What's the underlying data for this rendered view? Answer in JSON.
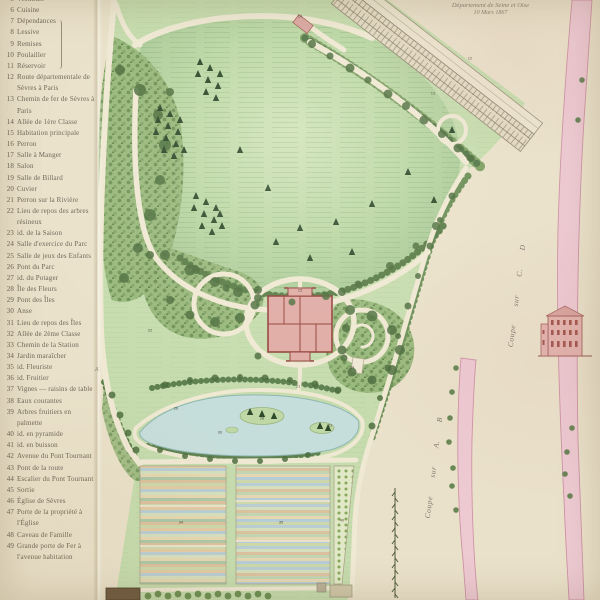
{
  "title": {
    "line1": "Département de Seine et Oise",
    "line2": "10 Mars 1867"
  },
  "legend": {
    "items": [
      {
        "num": "5",
        "label": "Vestibule"
      },
      {
        "num": "6",
        "label": "Cuisine"
      },
      {
        "num": "7",
        "label": "Dépendances"
      },
      {
        "num": "8",
        "label": "Lessive"
      },
      {
        "num": "9",
        "label": "Remises"
      },
      {
        "num": "10",
        "label": "Poulailler"
      },
      {
        "num": "11",
        "label": "Réservoir"
      },
      {
        "num": "12",
        "label": "Route départementale de Sèvres à Paris"
      },
      {
        "num": "13",
        "label": "Chemin de fer de Sèvres à Paris"
      },
      {
        "num": "14",
        "label": "Allée de 1ère Classe"
      },
      {
        "num": "15",
        "label": "Habitation principale"
      },
      {
        "num": "16",
        "label": "Perron"
      },
      {
        "num": "17",
        "label": "Salle à Manger"
      },
      {
        "num": "18",
        "label": "Salon"
      },
      {
        "num": "19",
        "label": "Salle de Billard"
      },
      {
        "num": "20",
        "label": "Cuvier"
      },
      {
        "num": "21",
        "label": "Perron sur la Rivière"
      },
      {
        "num": "22",
        "label": "Lieu de repos des arbres résineux"
      },
      {
        "num": "23",
        "label": "id. de la Saison"
      },
      {
        "num": "24",
        "label": "Salle d'exercice du Parc"
      },
      {
        "num": "25",
        "label": "Salle de jeux des Enfants"
      },
      {
        "num": "26",
        "label": "Pont du Parc"
      },
      {
        "num": "27",
        "label": "id. du Potager"
      },
      {
        "num": "28",
        "label": "Île des Fleurs"
      },
      {
        "num": "29",
        "label": "Pont des Îles"
      },
      {
        "num": "30",
        "label": "Anse"
      },
      {
        "num": "31",
        "label": "Lieu de repos des Îles"
      },
      {
        "num": "32",
        "label": "Allée de 2ème Classe"
      },
      {
        "num": "33",
        "label": "Chemin de la Station"
      },
      {
        "num": "34",
        "label": "Jardin maraîcher"
      },
      {
        "num": "35",
        "label": "id. Fleuriste"
      },
      {
        "num": "36",
        "label": "id. Fruitier"
      },
      {
        "num": "37",
        "label": "Vignes — raisins de table"
      },
      {
        "num": "38",
        "label": "Eaux courantes"
      },
      {
        "num": "39",
        "label": "Arbres fruitiers en palmette"
      },
      {
        "num": "40",
        "label": "id. en pyramide"
      },
      {
        "num": "41",
        "label": "id. en buisson"
      },
      {
        "num": "42",
        "label": "Avenue du Pont Tournant"
      },
      {
        "num": "43",
        "label": "Pont de la route"
      },
      {
        "num": "44",
        "label": "Escalier du Pont Tournant"
      },
      {
        "num": "45",
        "label": "Sortie"
      },
      {
        "num": "46",
        "label": "Église de Sèvres"
      },
      {
        "num": "47",
        "label": "Porte de la propriété à l'Église"
      },
      {
        "num": "48",
        "label": "Caveau de Famille"
      },
      {
        "num": "49",
        "label": "Grande porte de Fer à l'avenue habitation"
      }
    ]
  },
  "map": {
    "labels": {
      "coupe_cd": "Coupe sur C. D",
      "coupe_ab": "Coupe sur A. B",
      "marker_a": "A"
    },
    "numbers": [
      {
        "n": "12",
        "x": 470,
        "y": 58
      },
      {
        "n": "13",
        "x": 433,
        "y": 93
      },
      {
        "n": "14",
        "x": 300,
        "y": 16
      },
      {
        "n": "22",
        "x": 150,
        "y": 330
      },
      {
        "n": "15",
        "x": 300,
        "y": 290
      },
      {
        "n": "24",
        "x": 352,
        "y": 367
      },
      {
        "n": "21",
        "x": 298,
        "y": 386
      },
      {
        "n": "26",
        "x": 176,
        "y": 408
      },
      {
        "n": "28",
        "x": 262,
        "y": 418
      },
      {
        "n": "30",
        "x": 220,
        "y": 432
      },
      {
        "n": "31",
        "x": 330,
        "y": 425
      },
      {
        "n": "34",
        "x": 181,
        "y": 522
      },
      {
        "n": "35",
        "x": 281,
        "y": 522
      },
      {
        "n": "40",
        "x": 342,
        "y": 520
      }
    ]
  },
  "colors": {
    "paper": "#eae1ca",
    "lawn": "#bdd6a6",
    "woodland": "#97b77a",
    "dark_trees": "#4e6f3e",
    "path_cream": "#efe8d3",
    "water": "#c6dedb",
    "building_pink": "#e0aba5",
    "building_wall": "#94443d",
    "section_pink": "#edc9d2",
    "ink": "#6e6758"
  }
}
